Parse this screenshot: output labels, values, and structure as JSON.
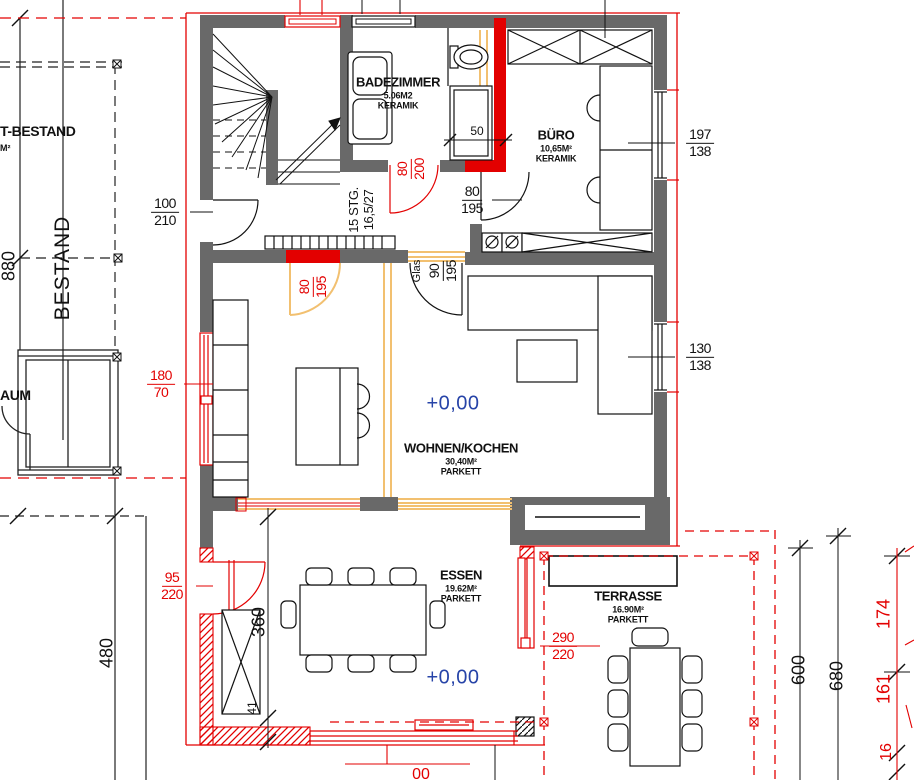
{
  "colors": {
    "wall_gray": "#696969",
    "new_red": "#e30000",
    "glazing_orange": "#f2c070",
    "level_blue": "#2744a8",
    "line_black": "#1a1a1a"
  },
  "rooms": {
    "badezimmer": {
      "name": "BADEZIMMER",
      "area": "5.06M2",
      "floor": "KERAMIK"
    },
    "buero": {
      "name": "BÜRO",
      "area": "10,65M²",
      "floor": "KERAMIK"
    },
    "wohnen_kochen": {
      "name": "WOHNEN/KOCHEN",
      "area": "30,40M²",
      "floor": "PARKETT"
    },
    "essen": {
      "name": "ESSEN",
      "area": "19.62M²",
      "floor": "PARKETT"
    },
    "terrasse": {
      "name": "TERRASSE",
      "area": "16.90M²",
      "floor": "PARKETT"
    }
  },
  "levels": {
    "wohnen": "+0,00",
    "essen": "+0,00"
  },
  "existing": {
    "label_top_partial": "T-BESTAND",
    "label_top_sub_partial": "M²",
    "bestand_axis": "BESTAND",
    "label_room_partial": "AUM"
  },
  "stairs": {
    "count": "15 STG.",
    "ratio": "16,5/27"
  },
  "openings": {
    "door_entry": {
      "w": "100",
      "h": "210"
    },
    "door_buero": {
      "w": "80",
      "h": "195"
    },
    "door_bad": {
      "w": "80",
      "h": "200"
    },
    "door_kueche": {
      "w": "80",
      "h": "195"
    },
    "door_glas": {
      "label": "Glas",
      "w": "90",
      "h": "195"
    },
    "door_essen": {
      "w": "95",
      "h": "220"
    },
    "door_terrasse": {
      "w": "290",
      "h": "220"
    },
    "window_buero": {
      "w": "197",
      "h": "138"
    },
    "window_wohnen": {
      "w": "130",
      "h": "138"
    },
    "window_links": {
      "w": "180",
      "h": "70"
    },
    "niche": {
      "w": "50"
    }
  },
  "dims": {
    "v880": "880",
    "v480": "480",
    "v360": "360",
    "v41": "41",
    "v600": "600",
    "v680": "680",
    "r174": "174",
    "r161": "161",
    "r16": "16",
    "partial_bottom": "00"
  }
}
